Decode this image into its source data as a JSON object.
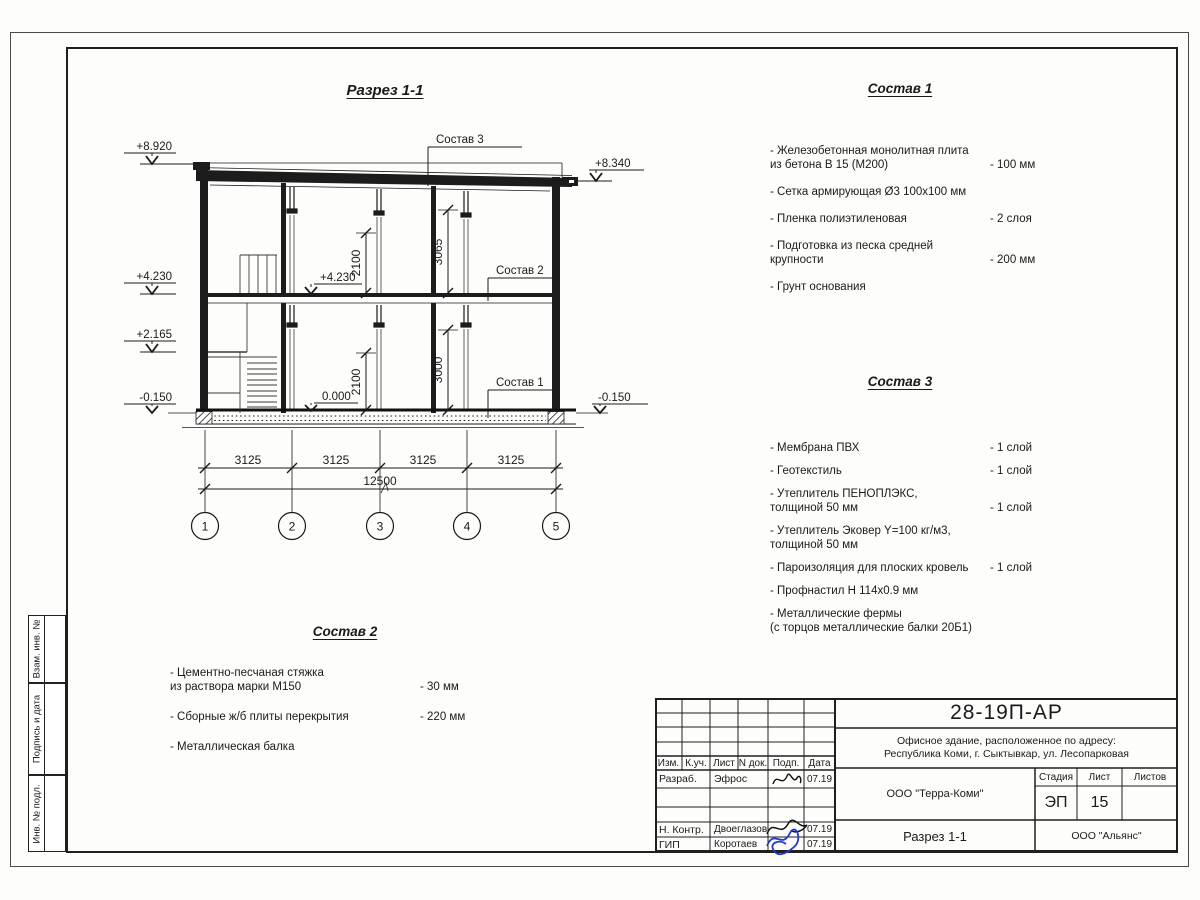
{
  "sheet": {
    "main_title": "Разрез 1-1"
  },
  "drawing": {
    "elev_left_top": "+8.920",
    "elev_left_floor2": "+4.230",
    "elev_left_landing": "+2.165",
    "elev_left_base": "-0.150",
    "elev_right_top": "+8.340",
    "elev_right_base": "-0.150",
    "elev_inner_floor2": "+4.230",
    "elev_inner_zero": "0.000",
    "vdim_floor2_opening": "2100",
    "vdim_floor2_height": "3065",
    "vdim_floor1_opening": "2100",
    "vdim_floor1_height": "3000",
    "leader_roof": "Состав 3",
    "leader_floor": "Состав 2",
    "leader_ground": "Состав 1",
    "span_dims": [
      "3125",
      "3125",
      "3125",
      "3125"
    ],
    "total_dim": "12500",
    "axes": [
      "1",
      "2",
      "3",
      "4",
      "5"
    ]
  },
  "comp1": {
    "title": "Состав 1",
    "items": [
      {
        "name": "- Железобетонная  монолитная плита\nиз бетона В 15 (М200)",
        "value": "- 100 мм"
      },
      {
        "name": "- Сетка армирующая Ø3 100х100 мм",
        "value": ""
      },
      {
        "name": "- Пленка полиэтиленовая",
        "value": "-  2 слоя"
      },
      {
        "name": "- Подготовка из песка средней\nкрупности",
        "value": "- 200 мм"
      },
      {
        "name": "- Грунт основания",
        "value": ""
      }
    ]
  },
  "comp3": {
    "title": "Состав 3",
    "items": [
      {
        "name": "- Мембрана ПВХ",
        "value": "- 1 слой"
      },
      {
        "name": "- Геотекстиль",
        "value": "- 1 слой"
      },
      {
        "name": "- Утеплитель ПЕНОПЛЭКС,\nтолщиной 50 мм",
        "value": "- 1 слой"
      },
      {
        "name": "- Утеплитель Эковер Y=100 кг/м3,\nтолщиной 50 мм",
        "value": "- 3 слоя"
      },
      {
        "name": "- Пароизоляция для плоских кровель",
        "value": "- 1 слой"
      },
      {
        "name": "- Профнастил Н 114х0.9 мм",
        "value": ""
      },
      {
        "name": "- Металлические фермы\n(с торцов металлические балки 20Б1)",
        "value": ""
      }
    ]
  },
  "comp2": {
    "title": "Состав 2",
    "items": [
      {
        "name": "- Цементно-песчаная стяжка\nиз раствора марки М150",
        "value": "- 30 мм"
      },
      {
        "name": "- Сборные ж/б плиты перекрытия",
        "value": "- 220 мм"
      },
      {
        "name": "- Металлическая балка",
        "value": ""
      }
    ]
  },
  "titleblock": {
    "doc_code": "28-19П-АР",
    "object_info": "Офисное здание, расположенное по адресу:\nРеспублика Коми, г. Сыктывкар, ул. Лесопарковая",
    "org": "ООО \"Терра-Коми\"",
    "sheet_name": "Разрез 1-1",
    "contractor": "ООО \"Альянс\"",
    "col_izm": "Изм.",
    "col_kuch": "К.уч.",
    "col_list": "Лист",
    "col_ndok": "N док.",
    "col_podp": "Подп.",
    "col_data": "Дата",
    "stage_label": "Стадия",
    "list_label": "Лист",
    "listov_label": "Листов",
    "stage": "ЭП",
    "sheet_no": "15",
    "sheets_total": "",
    "row1_role": "Разраб.",
    "row1_name": "Эфрос",
    "row1_date": "07.19",
    "row4_role": "Н. Контр.",
    "row4_name": "Двоеглазов",
    "row4_date": "07.19",
    "row5_role": "ГИП",
    "row5_name": "Коротаев",
    "row5_date": "07.19"
  },
  "side_stamp": {
    "box1": "Взам. инв. №",
    "box2": "Подпись и дата",
    "box3": "Инв. № подл."
  },
  "colors": {
    "ink": "#1a1a1a",
    "signature_blue": "#2438cc"
  }
}
